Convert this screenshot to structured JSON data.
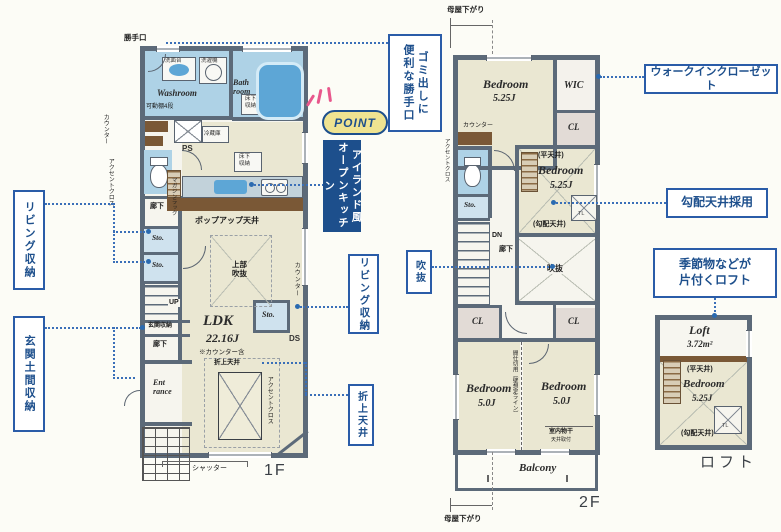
{
  "colors": {
    "wall": "#5c6a79",
    "room_cream": "#eae7d2",
    "room_wet": "#aed2e6",
    "wood": "#7a5836",
    "callout_blue": "#1d4f8c",
    "leader_blue": "#3a6fb8",
    "point_bg": "#efe391",
    "point_pink": "#e8578c"
  },
  "f1": {
    "label": "1F",
    "katteguchi": "勝手口",
    "senmendai": "洗面台",
    "sentakuki": "洗濯機",
    "washroom": "Washroom",
    "bath": "Bath\nroom",
    "yukashita_wash": "床下\n収納",
    "kadoudana": "可動棚4段",
    "counter_left": "カウンター",
    "accent_left": "アクセントクロス",
    "ps": "PS",
    "reizouko": "冷蔵庫",
    "yukashita_kitchen": "床下\n収納",
    "magazine": "マガジンラック",
    "popup": "ポップアップ天井",
    "joubu_fukinuke": "上部\n吹抜",
    "counter_right": "カウンター",
    "rouka1": "廊下",
    "sto1": "Sto.",
    "sto2": "Sto.",
    "sto3": "Sto.",
    "up": "UP",
    "genkan_shuno": "玄関収納",
    "rouka2": "廊下",
    "entrance": "Ent\nrance",
    "ldk": "LDK",
    "ldk_size": "22.16J",
    "ldk_note": "※カウンター含",
    "ds": "DS",
    "oriage": "折上天井",
    "accent_right": "アクセントクロス",
    "shutter": "シャッター"
  },
  "f2": {
    "label": "2F",
    "moya_top": "母屋下がり",
    "moya_bottom": "母屋下がり",
    "bed1": "Bedroom",
    "bed1_size": "5.25J",
    "wic": "WIC",
    "counter": "カウンター",
    "cl1": "CL",
    "accent": "アクセントクロス",
    "sto": "Sto.",
    "dn": "DN",
    "rouka": "廊下",
    "hira": "(平天井)",
    "bed2": "Bedroom",
    "bed2_size": "5.25J",
    "kobai": "(勾配天井)",
    "tl": "TL",
    "fukinuke": "吹抜",
    "cl2": "CL",
    "cl3": "CL",
    "bed3": "Bedroom",
    "bed3_size": "5.0J",
    "bed4": "Bedroom",
    "bed4_size": "5.0J",
    "partition": "間仕切用（壁想定ライン）",
    "monohoshi": "室内物干",
    "monohoshi2": "天井取付",
    "balcony": "Balcony"
  },
  "loft": {
    "title": "Loft",
    "size": "3.72m²",
    "hira": "(平天井)",
    "bed": "Bedroom",
    "bed_size": "5.25J",
    "kobai": "(勾配天井)",
    "tl": "TL",
    "caption": "ロフト"
  },
  "callouts": {
    "gomi": "ゴミ出しに\n便利な勝手口",
    "point": "POINT",
    "island": "アイランド風\nオープンキッチン",
    "living_l": "リビング収納",
    "doma": "玄関土間収納",
    "living_r": "リビング収納",
    "oriage": "折上天井",
    "fukinuke": "吹抜",
    "wic": "ウォークインクローゼット",
    "kobai": "勾配天井採用",
    "loft": "季節物などが\n片付くロフト"
  }
}
